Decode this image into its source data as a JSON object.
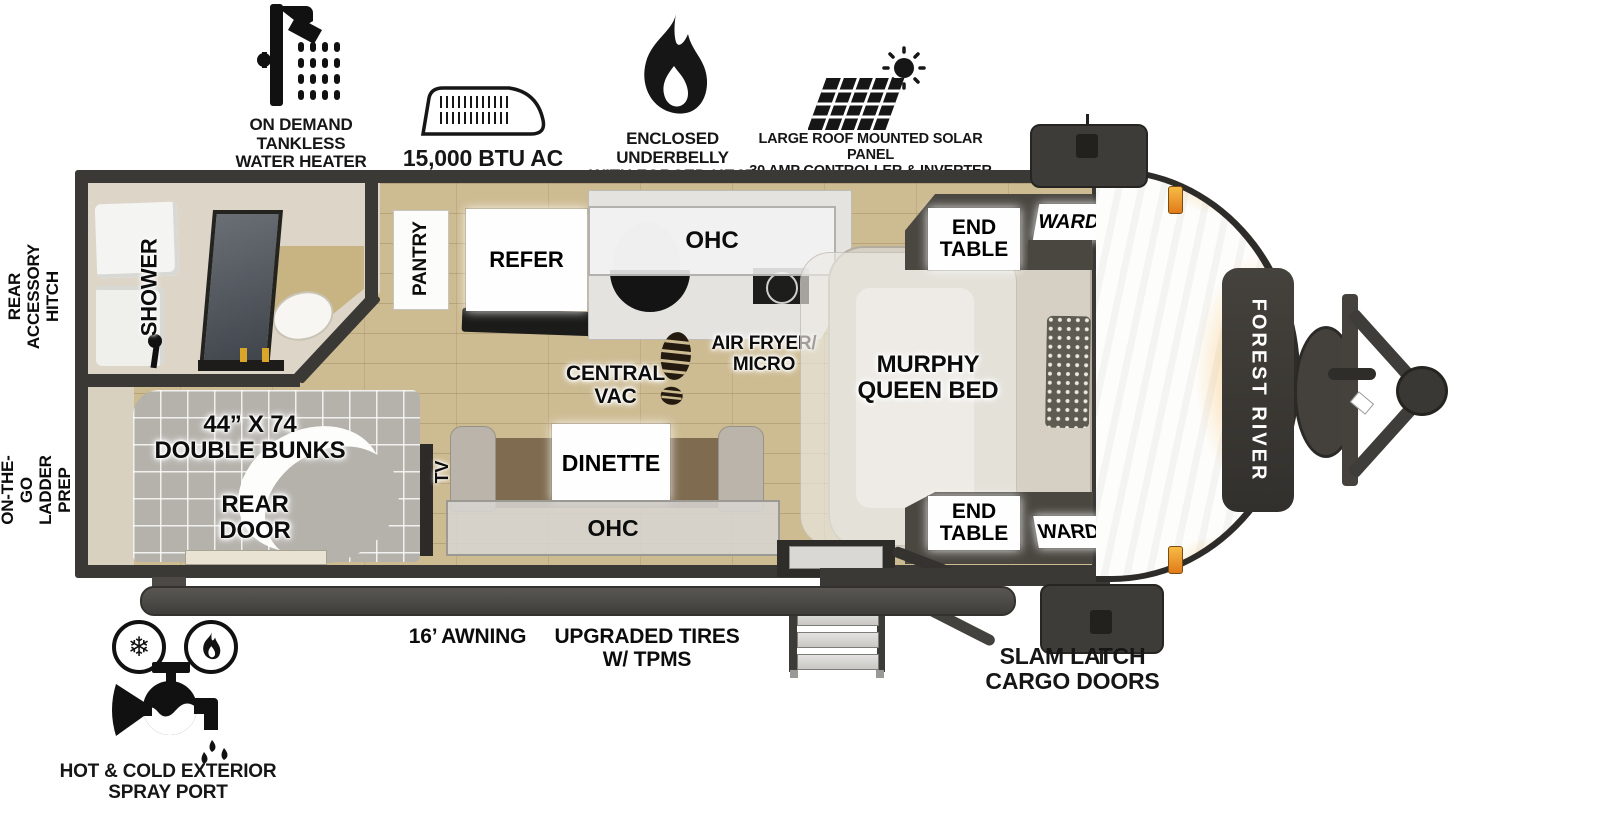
{
  "features": {
    "water_heater": "ON DEMAND\nTANKLESS\nWATER HEATER",
    "ac": "15,000 BTU AC",
    "underbelly": "ENCLOSED UNDERBELLY\nWITH FORCED HEAT",
    "solar": "LARGE ROOF MOUNTED SOLAR PANEL\n30 AMP CONTROLLER & INVERTER PREP"
  },
  "exterior": {
    "rear_accessory_hitch": "REAR\nACCESSORY\nHITCH",
    "ladder_prep": "ON-THE-GO\nLADDER PREP",
    "awning": "16’ AWNING",
    "tires": "UPGRADED TIRES\nW/ TPMS",
    "cargo_doors": "SLAM LATCH\nCARGO DOORS",
    "spray_port": "HOT & COLD EXTERIOR\nSPRAY PORT",
    "brand": "FOREST RIVER"
  },
  "interior": {
    "shower": "SHOWER",
    "pantry": "PANTRY",
    "refer": "REFER",
    "kitchen_ohc": "OHC",
    "air_fryer": "AIR FRYER/\nMICRO",
    "central_vac": "CENTRAL\nVAC",
    "murphy_bed": "MURPHY\nQUEEN BED",
    "bunks": "44” X 74\nDOUBLE BUNKS",
    "rear_door": "REAR\nDOOR",
    "tv": "TV",
    "dinette": "DINETTE",
    "dinette_ohc": "OHC",
    "end_table_top": "END\nTABLE",
    "end_table_bottom": "END\nTABLE",
    "ward_top": "WARD",
    "ward_bottom": "WARD"
  },
  "icons": {
    "snowflake": "❄"
  },
  "colors": {
    "wall": "#3b3936",
    "floor": "#cdbb92",
    "accent_amber": "#f0a62a",
    "marker_light": "#e8821e",
    "mattress": "#b5b2ac"
  }
}
